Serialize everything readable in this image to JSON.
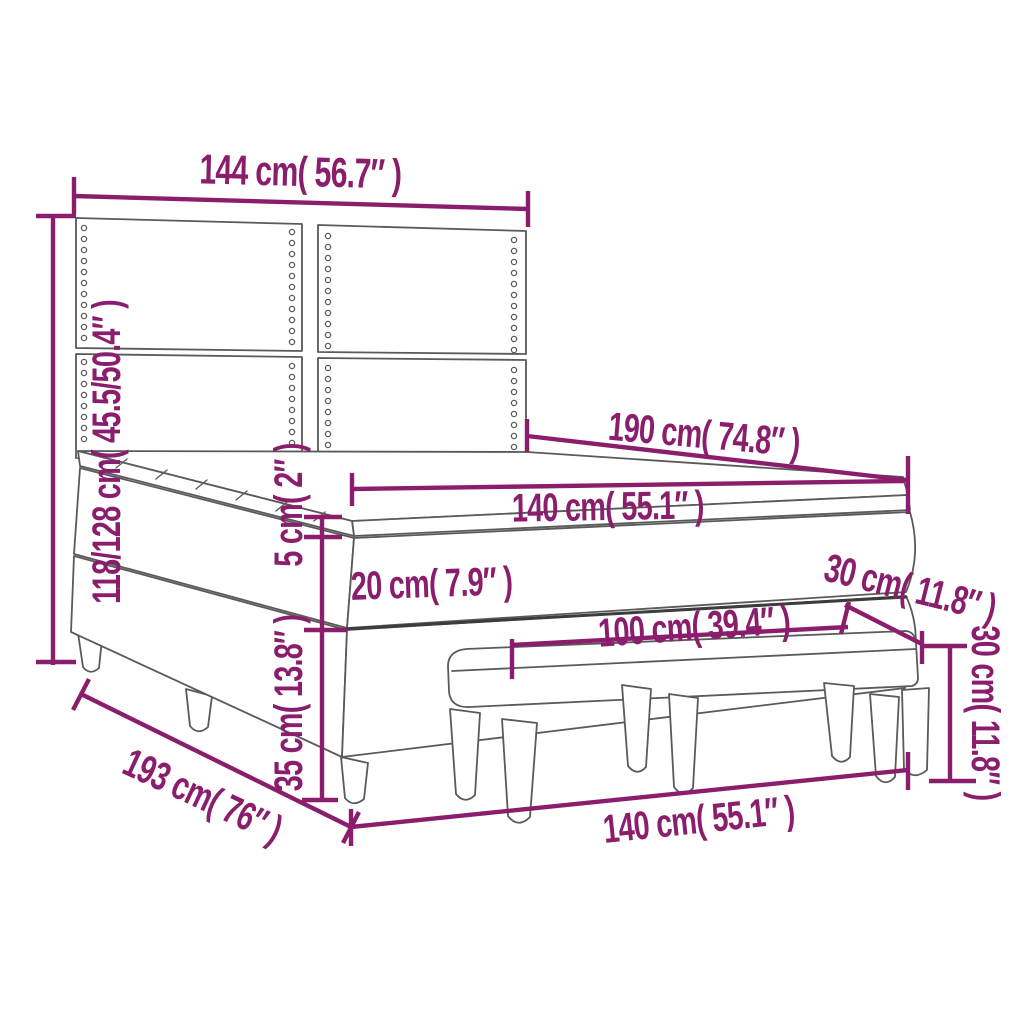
{
  "diagram": {
    "title": "box spring bed with headboard and bench dimension diagram",
    "colors": {
      "dimension": "#8A1E6C",
      "line": "#5A5A5A",
      "seam": "#3C3C3C",
      "background": "#FFFFFF"
    },
    "labels": {
      "headboard_width": "144 cm( 56.7″ )",
      "overall_height": "118/128 cm( 45.5/50.4″ )",
      "bed_length": "190 cm( 74.8″ )",
      "mattress_width": "140 cm( 55.1″ )",
      "topper_thickness": "5 cm( 2″ )",
      "mattress_thickness": "20 cm( 7.9″ )",
      "base_height": "35 cm( 13.8″ )",
      "frame_length": "193 cm( 76″ )",
      "bench_length": "100 cm( 39.4″ )",
      "bench_depth": "30 cm( 11.8″ )",
      "bench_height": "30 cm( 11.8″ )",
      "bench_width": "140 cm( 55.1″ )"
    }
  }
}
